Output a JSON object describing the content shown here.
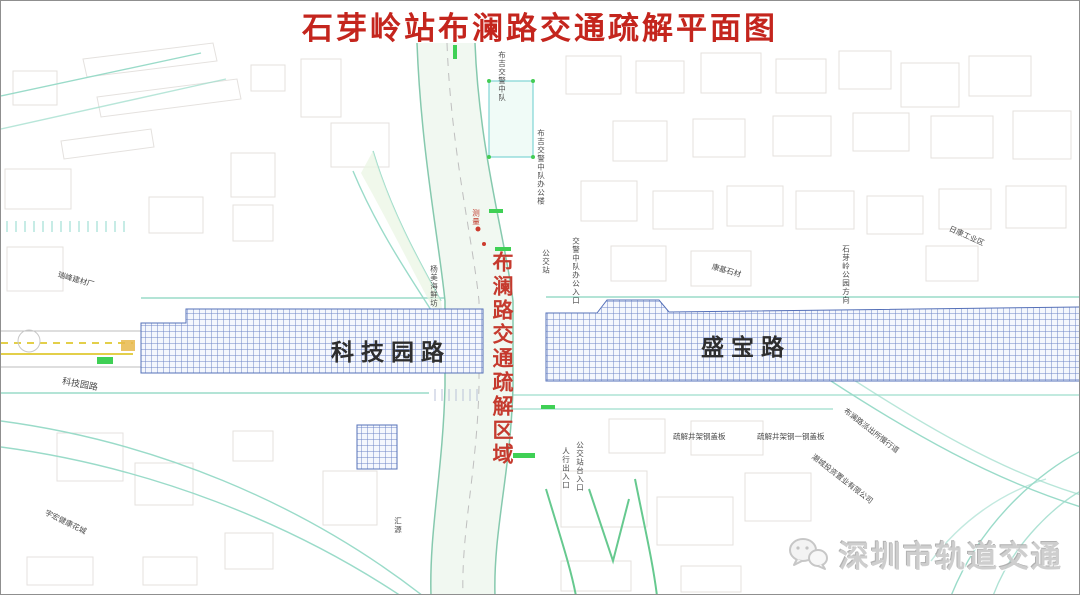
{
  "title": "石芽岭站布澜路交通疏解平面图",
  "zone_label": "布澜路交通疏解区域",
  "roads": {
    "left_label": "科技园路",
    "right_label": "盛宝路"
  },
  "watermark": {
    "text": "深圳市轨道交通",
    "icon": "wechat-icon"
  },
  "colors": {
    "title_red": "#c4251d",
    "zone_red": "#c53a2e",
    "hatch_blue": "#5b79c0",
    "median_green": "#3fd055",
    "edge_teal": "#8fd8cc",
    "lane_yellow": "#e3cf4a"
  },
  "annotations": [
    {
      "text": "布吉交警中队"
    },
    {
      "text": "布吉交警中队办公楼"
    },
    {
      "text": "测量"
    },
    {
      "text": "公交站"
    },
    {
      "text": "交警中队办公入口"
    },
    {
      "text": "杨美海鲜坊"
    },
    {
      "text": "瑞峰建材厂"
    },
    {
      "text": "康基石材"
    },
    {
      "text": "日康工业区"
    },
    {
      "text": "石芽岭公园方向"
    },
    {
      "text": "疏解井架钢盖板"
    },
    {
      "text": "疏解井架钢一钢盖板"
    },
    {
      "text": "布澜路派出所慢行道"
    },
    {
      "text": "潮城投资置业有限公司"
    },
    {
      "text": "科技园路"
    },
    {
      "text": "汇源"
    },
    {
      "text": "宇宏健康花城"
    },
    {
      "text": "人行出入口"
    },
    {
      "text": "公交站台入口"
    }
  ]
}
